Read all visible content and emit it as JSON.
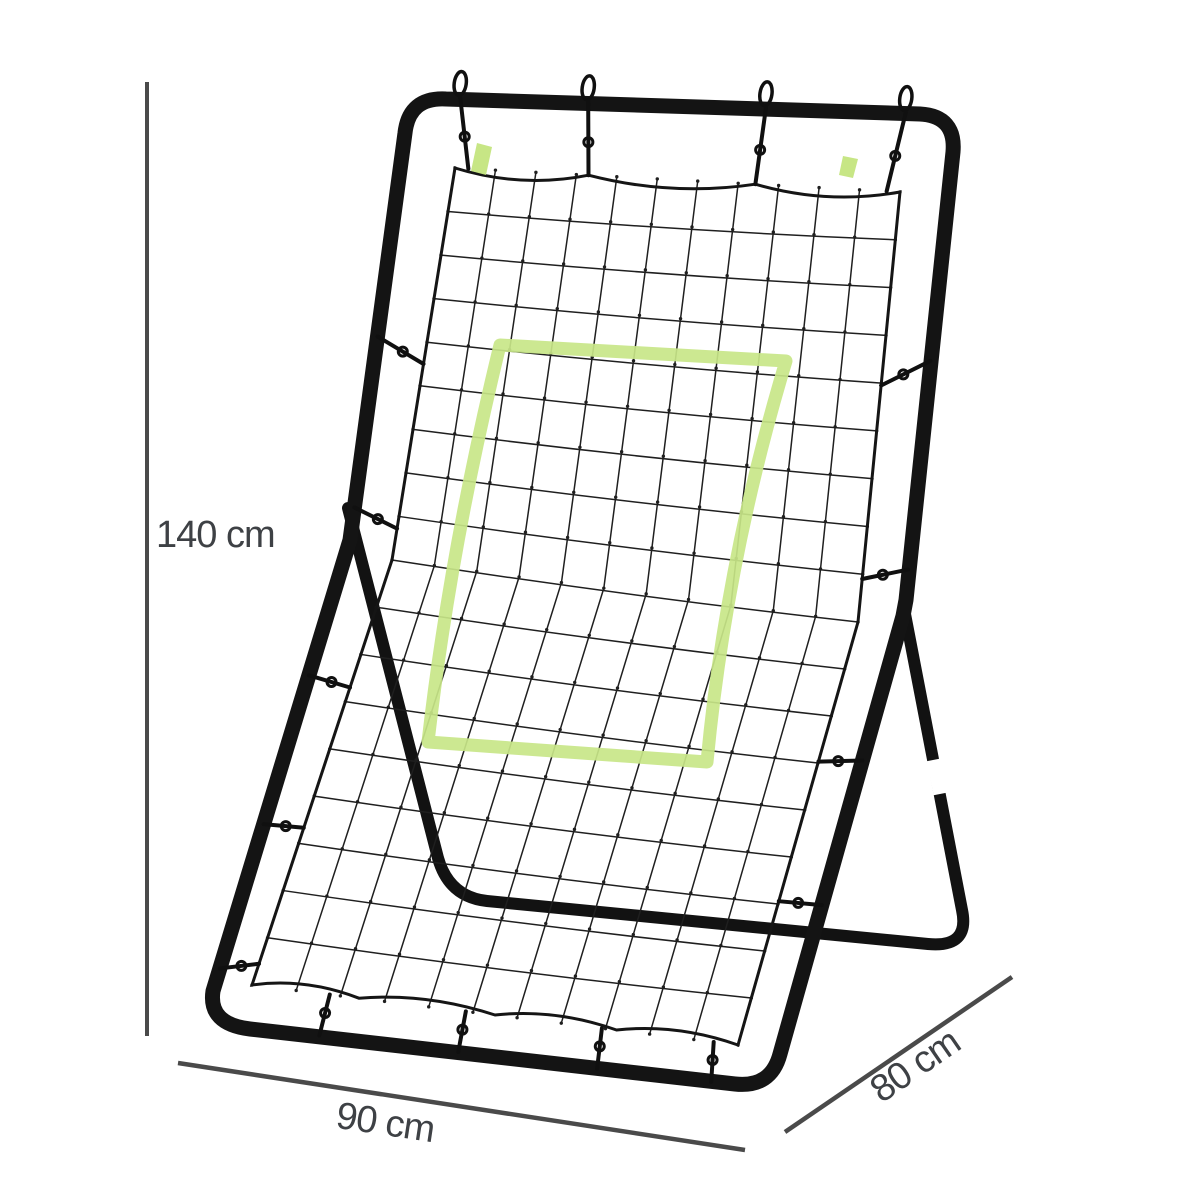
{
  "dimensions": {
    "height": {
      "label": "140 cm"
    },
    "width": {
      "label": "90 cm"
    },
    "depth": {
      "label": "80 cm"
    }
  },
  "colors": {
    "background": "#ffffff",
    "frame": "#141414",
    "rear_frame": "#121212",
    "net_line": "#1f1f1f",
    "net_border": "#151515",
    "target_green": "#c8e688",
    "tape_green": "#c4e57e",
    "leg_band_white": "#ffffff",
    "dimension_line": "#4a4a4a",
    "label_text": "#3e4145"
  }
}
